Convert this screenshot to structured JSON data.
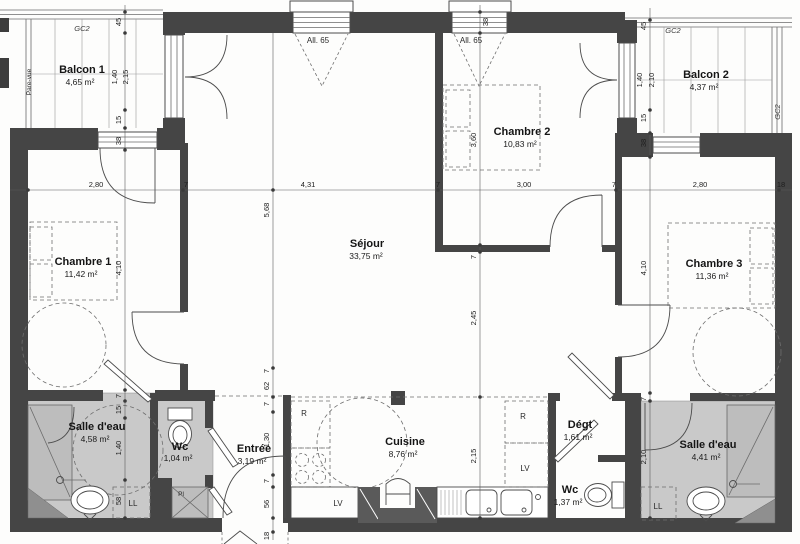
{
  "rooms": {
    "balcon1": {
      "name": "Balcon 1",
      "area": "4,65 m²"
    },
    "balcon2": {
      "name": "Balcon 2",
      "area": "4,37 m²"
    },
    "chambre1": {
      "name": "Chambre 1",
      "area": "11,42 m²"
    },
    "chambre2": {
      "name": "Chambre 2",
      "area": "10,83 m²"
    },
    "chambre3": {
      "name": "Chambre 3",
      "area": "11,36 m²"
    },
    "sejour": {
      "name": "Séjour",
      "area": "33,75 m²"
    },
    "cuisine": {
      "name": "Cuisine",
      "area": "8,76 m²"
    },
    "entree": {
      "name": "Entrée",
      "area": "3,19 m²"
    },
    "salle_eau_1": {
      "name": "Salle d'eau",
      "area": "4,58 m²"
    },
    "wc1": {
      "name": "Wc",
      "area": "1,04 m²"
    },
    "degt": {
      "name": "Dégt",
      "area": "1,61 m²"
    },
    "wc2": {
      "name": "Wc",
      "area": "1,37 m²"
    },
    "salle_eau_2": {
      "name": "Salle d'eau",
      "area": "4,41 m²"
    }
  },
  "labels": {
    "gc2": "GC2",
    "pare_vue": "Pare-vue",
    "all65": "All. 65",
    "r": "R",
    "lv": "LV",
    "ll": "LL",
    "pl": "Pl"
  },
  "dims": {
    "h_top": [
      "2,80",
      "7",
      "4,31",
      "7",
      "3,00",
      "7",
      "2,80",
      "18"
    ],
    "v_left": [
      "45",
      "1,40",
      "2,15",
      "15",
      "38",
      "4,10",
      "7",
      "15",
      "1,40",
      "58"
    ],
    "v_mid": [
      "5,68",
      "7",
      "62",
      "7",
      "1,30",
      "7",
      "56",
      "18"
    ],
    "v_center": [
      "38",
      "3,60",
      "7",
      "2,45",
      "2,15"
    ],
    "v_right": [
      "45",
      "1,40",
      "2,10",
      "15",
      "38",
      "4,10",
      "7",
      "2,10"
    ]
  }
}
